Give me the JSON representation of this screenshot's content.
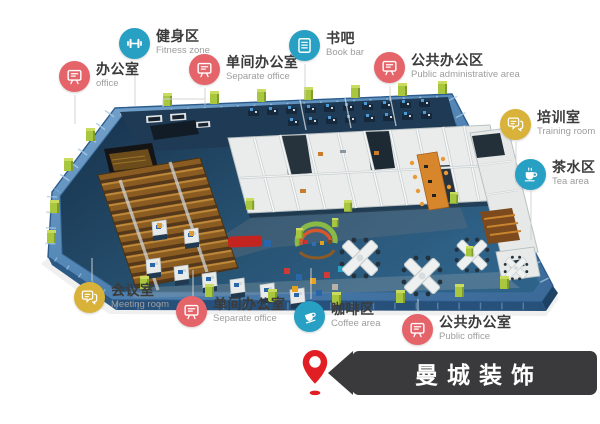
{
  "legend": {
    "items": [
      {
        "id": "office",
        "zh": "办公室",
        "en": "office",
        "color": "#e4646a",
        "icon": "monitor"
      },
      {
        "id": "fitness",
        "zh": "健身区",
        "en": "Fitness zone",
        "color": "#28a0c4",
        "icon": "dumbbell"
      },
      {
        "id": "separate-office-top",
        "zh": "单间办公室",
        "en": "Separate office",
        "color": "#e4646a",
        "icon": "monitor"
      },
      {
        "id": "book-bar",
        "zh": "书吧",
        "en": "Book bar",
        "color": "#28a0c4",
        "icon": "book"
      },
      {
        "id": "public-admin",
        "zh": "公共办公区",
        "en": "Public administrative area",
        "color": "#e4646a",
        "icon": "monitor"
      },
      {
        "id": "training",
        "zh": "培训室",
        "en": "Training room",
        "color": "#d9b23a",
        "icon": "chat"
      },
      {
        "id": "tea",
        "zh": "茶水区",
        "en": "Tea area",
        "color": "#28a0c4",
        "icon": "teacup"
      },
      {
        "id": "meeting",
        "zh": "会议室",
        "en": "Meeting room",
        "color": "#d9b23a",
        "icon": "chat"
      },
      {
        "id": "separate-office-bottom",
        "zh": "单间办公室",
        "en": "Separate office",
        "color": "#e4646a",
        "icon": "monitor"
      },
      {
        "id": "coffee",
        "zh": "咖啡区",
        "en": "Coffee area",
        "color": "#28a0c4",
        "icon": "coffee"
      },
      {
        "id": "public-office",
        "zh": "公共办公室",
        "en": "Public office",
        "color": "#e4646a",
        "icon": "monitor"
      }
    ]
  },
  "brand": {
    "name": "曼城装饰",
    "banner_color": "#3a3a3c",
    "text_color": "#ffffff",
    "pin_color": "#e01e24"
  },
  "palette": {
    "glass": "#4f82b2",
    "floor_dark": "#1d3b55",
    "wall_white": "#e9eceb",
    "accent_green": "#a9c63f",
    "seat_brown": "#8a5c22",
    "table_orange": "#d8862c",
    "leader_gray": "#d2d2d2"
  }
}
